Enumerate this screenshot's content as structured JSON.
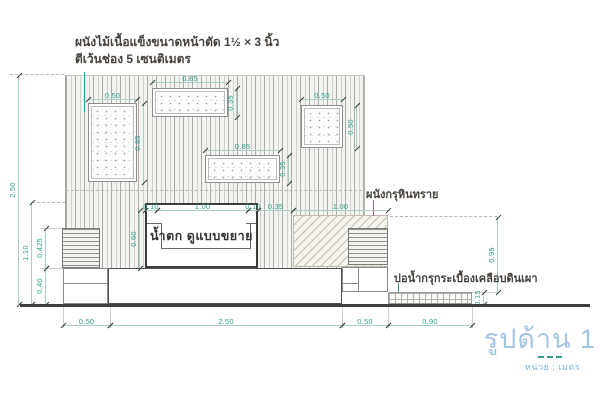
{
  "annotations": {
    "material_note": {
      "line1": "ผนังไม้เนื้อแข็งขนาดหน้าตัด 1½ × 3 นิ้ว",
      "line2": "ตีเว้นช่อง 5 เซนติเมตร"
    },
    "sandstone_wall_label": "ผนังกรุหินทราย",
    "pond_label": "บ่อน้ำกรุกระเบื้องเคลือบดินเผา",
    "waterfall_label": "น้ำตก  ดูแบบขยาย"
  },
  "dimensions": {
    "left_panel_width": "0.50",
    "left_panel_height": "0.85",
    "top_panel_width": "0.85",
    "top_panel_height": "0.35",
    "mid_panel_width": "0.85",
    "mid_panel_height": "0.35",
    "right_panel_width": "0.50",
    "right_panel_height": "0.50",
    "waterfall_left_lip": "0.10",
    "waterfall_inner_width": "1.00",
    "waterfall_right_lip": "0.10",
    "gap_to_stone_wall": "0.35",
    "stone_wall_width": "1.00",
    "waterfall_height": "0.60",
    "total_wall_height": "2.50",
    "waterfall_top_level": "1.10",
    "planter_height": "0.425",
    "base_height": "0.40",
    "stone_wall_height": "0.95",
    "pond_depth": "0.15",
    "base_left_width": "0.50",
    "base_center_width": "2.50",
    "base_right_width": "0.50",
    "pond_width": "0.90"
  },
  "title_block": {
    "title": "รูปด้าน 1",
    "unit": "หน่วย : เมตร"
  },
  "colors": {
    "dimension_text": "#2f9e8e",
    "dimension_line": "#a9cfc8",
    "annotation_text": "#46413c",
    "title_text": "#a4c5e7",
    "unit_text": "#7fb2d4",
    "heavy_line": "#3e3e3e"
  }
}
